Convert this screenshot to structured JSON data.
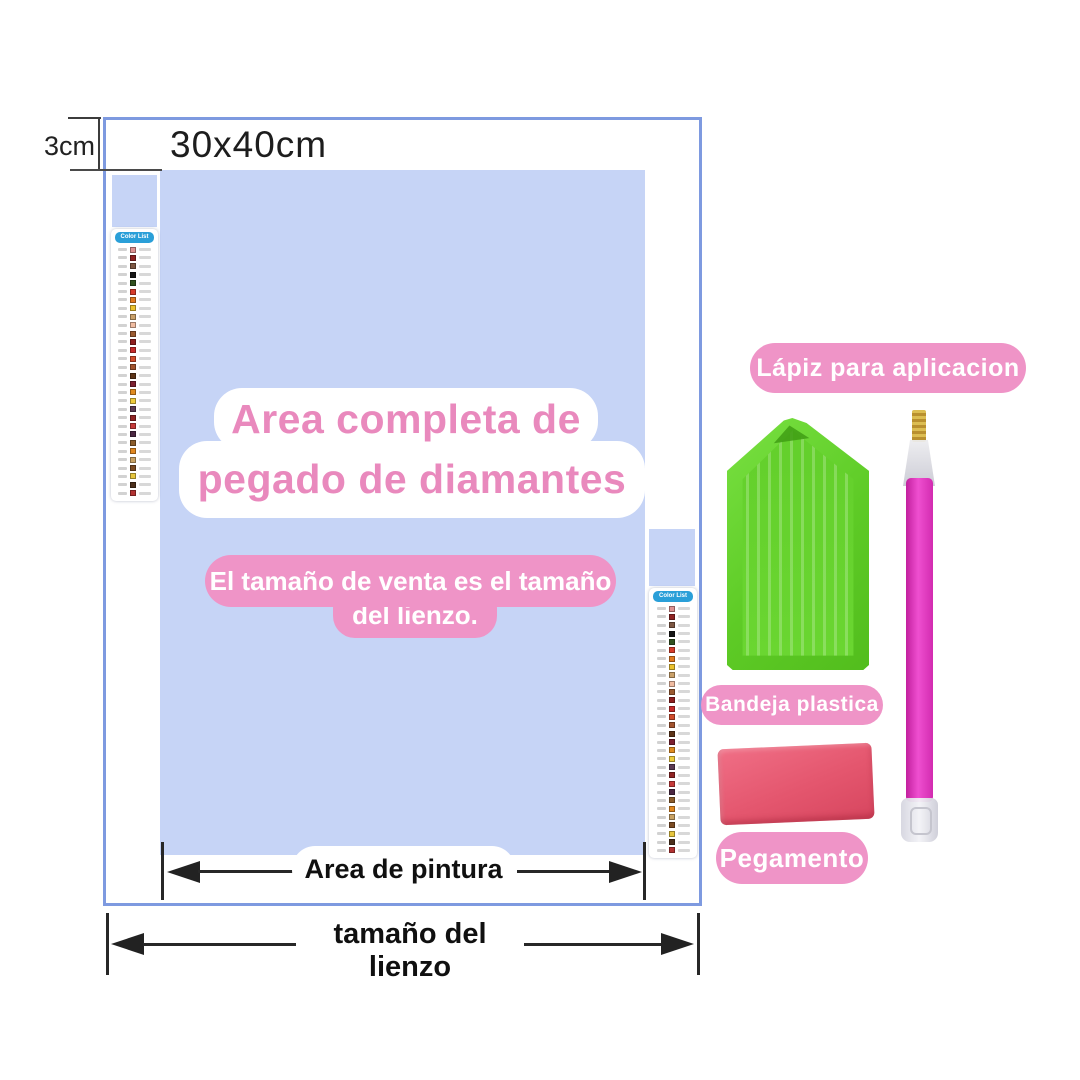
{
  "canvas": {
    "size_label": "30x40cm",
    "margin_label": "3cm",
    "paint_area_label": "Area de pintura",
    "canvas_size_label": "tamaño del lienzo"
  },
  "callout": {
    "line1": "Area completa de",
    "line2": "pegado de diamantes"
  },
  "note": {
    "line1": "El tamaño de venta es el tamaño",
    "line2": "del lienzo."
  },
  "legend": {
    "title": "Color List",
    "colors": [
      "#de9191",
      "#8f2222",
      "#7d5743",
      "#161616",
      "#31511f",
      "#d63b2a",
      "#e0791f",
      "#ecc22e",
      "#c9a069",
      "#f0bca1",
      "#9a5a30",
      "#8e1e1e",
      "#c62a2a",
      "#d14c2c",
      "#a2532e",
      "#5d3418",
      "#7c2030",
      "#e08b1f",
      "#eecb3d",
      "#5c3b54",
      "#902424",
      "#c63a3a",
      "#4b2742",
      "#8b5c2b",
      "#e1871f",
      "#c9a264",
      "#7b4b23",
      "#e7c63e",
      "#4b2f1b",
      "#b23232"
    ]
  },
  "accessories": {
    "pen_label": "Lápiz para aplicacion",
    "tray_label": "Bandeja plastica",
    "glue_label": "Pegamento"
  },
  "palette": {
    "accent_pink": "#ef94c7",
    "text_pink": "#e989bd",
    "inner_blue": "#c6d4f6",
    "border_blue": "#7e9ae0",
    "legend_header_blue": "#2a9fd8",
    "tray_green": "#5ecb26",
    "pen_magenta": "#ef4fd0",
    "wax_red": "#e4566e"
  }
}
